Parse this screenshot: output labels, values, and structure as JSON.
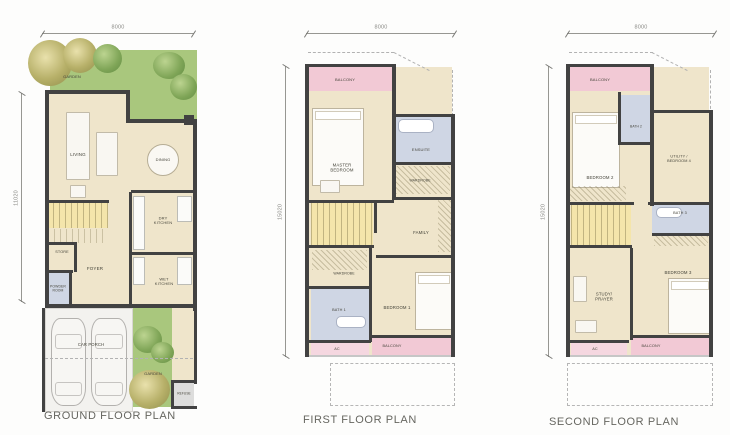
{
  "colors": {
    "wall": "#424242",
    "room": "#efe5cb",
    "balcony": "#f2c9d5",
    "ac": "#f5d7e0",
    "bath": "#cfd6e4",
    "stairs": "#f4e5ab",
    "garden": "#a9c77d",
    "porch": "#f3f2ef",
    "refuse": "#dddddc"
  },
  "plans": [
    {
      "id": "ground-floor",
      "title": "GROUND FLOOR PLAN",
      "tx": 44,
      "ty": 410,
      "dims": [
        {
          "o": "h",
          "label": "8000",
          "x": 42,
          "y": 33,
          "len": 152
        },
        {
          "o": "v",
          "label": "11020",
          "x": 21,
          "y": 93,
          "len": 209
        }
      ],
      "rooms": [
        {
          "id": "interior",
          "fill": "room",
          "x": 45,
          "y": 93,
          "w": 148,
          "h": 215
        },
        {
          "id": "garden-top",
          "fill": "garden",
          "x": 50,
          "y": 50,
          "w": 147,
          "h": 43,
          "label": "GARDEN",
          "lx": 72,
          "ly": 77,
          "fs": 4
        },
        {
          "id": "garden-top-right",
          "fill": "garden",
          "x": 128,
          "y": 93,
          "w": 69,
          "h": 29
        },
        {
          "id": "living",
          "label": "LIVING",
          "lx": 78,
          "ly": 155,
          "fs": 4.5
        },
        {
          "id": "dining",
          "label": "DINING",
          "lx": 163,
          "ly": 160,
          "fs": 4
        },
        {
          "id": "stairs",
          "fill": "stairs",
          "x": 47,
          "y": 203,
          "w": 61,
          "h": 25
        },
        {
          "id": "store",
          "label": "STORE",
          "lx": 62,
          "ly": 252,
          "fs": 3.8
        },
        {
          "id": "dry-kitchen",
          "label": "DRY\nKITCHEN",
          "lx": 163,
          "ly": 221,
          "fs": 4
        },
        {
          "id": "foyer",
          "label": "FOYER",
          "lx": 95,
          "ly": 269,
          "fs": 4.5
        },
        {
          "id": "powder-room",
          "fill": "bath",
          "x": 45,
          "y": 272,
          "w": 26,
          "h": 36,
          "label": "POWDER\nROOM",
          "lx": 58,
          "ly": 289,
          "fs": 3.4
        },
        {
          "id": "wet-kitchen",
          "label": "WET\nKITCHEN",
          "lx": 164,
          "ly": 282,
          "fs": 4
        },
        {
          "id": "walkway",
          "fill": "room",
          "x": 172,
          "y": 308,
          "w": 22,
          "h": 99
        },
        {
          "id": "car-porch",
          "fill": "porch",
          "x": 45,
          "y": 308,
          "w": 88,
          "h": 104,
          "label": "CAR PORCH",
          "lx": 91,
          "ly": 345,
          "fs": 4.2
        },
        {
          "id": "garden-bottom",
          "fill": "garden",
          "x": 133,
          "y": 308,
          "w": 39,
          "h": 99,
          "label": "GARDEN",
          "lx": 153,
          "ly": 374,
          "fs": 4
        },
        {
          "id": "refuse",
          "fill": "refuse",
          "x": 174,
          "y": 382,
          "w": 20,
          "h": 25,
          "label": "REFUSE",
          "lx": 184,
          "ly": 394,
          "fs": 3.2
        }
      ],
      "walls": [
        [
          45,
          90,
          85,
          4
        ],
        [
          126,
          90,
          4,
          33
        ],
        [
          126,
          119,
          71,
          4
        ],
        [
          45,
          90,
          4,
          218
        ],
        [
          193,
          119,
          4,
          192
        ],
        [
          45,
          304,
          152,
          4
        ],
        [
          45,
          200,
          64,
          3
        ],
        [
          45,
          242,
          32,
          3
        ],
        [
          74,
          242,
          3,
          30
        ],
        [
          45,
          270,
          28,
          3
        ],
        [
          69,
          270,
          3,
          38
        ],
        [
          129,
          192,
          3,
          116
        ],
        [
          131,
          190,
          62,
          3
        ],
        [
          131,
          252,
          62,
          3
        ],
        [
          42,
          308,
          3,
          104
        ],
        [
          194,
          308,
          3,
          76
        ],
        [
          171,
          380,
          26,
          3
        ],
        [
          171,
          380,
          3,
          27
        ],
        [
          171,
          406,
          26,
          3
        ],
        [
          184,
          115,
          10,
          10
        ]
      ],
      "decor": [
        {
          "type": "tree-olive",
          "x": 28,
          "y": 40,
          "w": 44,
          "h": 46
        },
        {
          "type": "tree-olive",
          "x": 63,
          "y": 38,
          "w": 34,
          "h": 35
        },
        {
          "type": "tree",
          "x": 93,
          "y": 44,
          "w": 29,
          "h": 29
        },
        {
          "type": "tree",
          "x": 153,
          "y": 52,
          "w": 32,
          "h": 27
        },
        {
          "type": "tree",
          "x": 170,
          "y": 74,
          "w": 27,
          "h": 26
        },
        {
          "type": "tree",
          "x": 133,
          "y": 326,
          "w": 29,
          "h": 27
        },
        {
          "type": "tree",
          "x": 151,
          "y": 342,
          "w": 23,
          "h": 21
        },
        {
          "type": "tree-olive",
          "x": 129,
          "y": 370,
          "w": 41,
          "h": 39
        },
        {
          "type": "car",
          "x": 51,
          "y": 318,
          "w": 35,
          "h": 88
        },
        {
          "type": "car",
          "x": 91,
          "y": 318,
          "w": 36,
          "h": 88
        },
        {
          "type": "furn",
          "x": 66,
          "y": 112,
          "w": 24,
          "h": 68
        },
        {
          "type": "furn",
          "x": 96,
          "y": 132,
          "w": 22,
          "h": 44
        },
        {
          "type": "furn",
          "x": 70,
          "y": 185,
          "w": 16,
          "h": 13
        },
        {
          "type": "table-round",
          "x": 147,
          "y": 144,
          "w": 32,
          "h": 32
        },
        {
          "type": "counter",
          "x": 133,
          "y": 196,
          "w": 12,
          "h": 54
        },
        {
          "type": "counter",
          "x": 177,
          "y": 196,
          "w": 15,
          "h": 26
        },
        {
          "type": "counter",
          "x": 133,
          "y": 257,
          "w": 12,
          "h": 28
        },
        {
          "type": "counter",
          "x": 177,
          "y": 257,
          "w": 15,
          "h": 28
        },
        {
          "type": "treads",
          "x": 48,
          "y": 229,
          "w": 58,
          "h": 14
        },
        {
          "type": "dash-h",
          "x": 45,
          "y": 358,
          "len": 148
        }
      ]
    },
    {
      "id": "first-floor",
      "title": "FIRST FLOOR PLAN",
      "tx": 303,
      "ty": 414,
      "dims": [
        {
          "o": "h",
          "label": "8000",
          "x": 306,
          "y": 33,
          "len": 149
        },
        {
          "o": "v",
          "label": "15020",
          "x": 285,
          "y": 66,
          "len": 291
        }
      ],
      "rooms": [
        {
          "id": "interior",
          "fill": "room",
          "x": 308,
          "y": 67,
          "w": 144,
          "h": 288
        },
        {
          "id": "balcony",
          "fill": "balcony",
          "x": 308,
          "y": 67,
          "w": 85,
          "h": 24,
          "label": "BALCONY",
          "lx": 345,
          "ly": 80,
          "fs": 4
        },
        {
          "id": "master-bedroom",
          "label": "MASTER\nBEDROOM",
          "lx": 342,
          "ly": 168,
          "fs": 4.3
        },
        {
          "id": "ensuite",
          "fill": "bath",
          "x": 395,
          "y": 117,
          "w": 56,
          "h": 46,
          "label": "ENSUITE",
          "lx": 421,
          "ly": 150,
          "fs": 4
        },
        {
          "id": "wardrobe-master",
          "label": "WARDROBE",
          "lx": 420,
          "ly": 181,
          "fs": 3.5
        },
        {
          "id": "stairs",
          "fill": "stairs",
          "x": 311,
          "y": 203,
          "w": 62,
          "h": 42
        },
        {
          "id": "family",
          "label": "FAMILY",
          "lx": 421,
          "ly": 233,
          "fs": 4.3
        },
        {
          "id": "wardrobe-hall",
          "label": "WARDROBE",
          "lx": 344,
          "ly": 274,
          "fs": 3.5
        },
        {
          "id": "bath-1",
          "fill": "bath",
          "x": 311,
          "y": 289,
          "w": 58,
          "h": 51,
          "label": "BATH 1",
          "lx": 339,
          "ly": 310,
          "fs": 3.8
        },
        {
          "id": "bedroom-1",
          "label": "BEDROOM 1",
          "lx": 397,
          "ly": 308,
          "fs": 4.3
        },
        {
          "id": "ac-ledge",
          "fill": "ac",
          "x": 311,
          "y": 343,
          "w": 58,
          "h": 12,
          "label": "AC",
          "lx": 337,
          "ly": 349,
          "fs": 3.8
        },
        {
          "id": "balcony-rear",
          "fill": "balcony",
          "x": 372,
          "y": 338,
          "w": 80,
          "h": 17,
          "label": "BALCONY",
          "lx": 392,
          "ly": 346,
          "fs": 3.8
        }
      ],
      "walls": [
        [
          305,
          64,
          4,
          293
        ],
        [
          305,
          64,
          91,
          3
        ],
        [
          392,
          64,
          4,
          135
        ],
        [
          392,
          114,
          63,
          3
        ],
        [
          451,
          114,
          4,
          243
        ],
        [
          396,
          162,
          58,
          3
        ],
        [
          392,
          197,
          63,
          3
        ],
        [
          308,
          200,
          86,
          3
        ],
        [
          376,
          255,
          78,
          3
        ],
        [
          308,
          245,
          66,
          3
        ],
        [
          308,
          286,
          64,
          3
        ],
        [
          369,
          248,
          3,
          94
        ],
        [
          374,
          203,
          3,
          30
        ],
        [
          308,
          340,
          63,
          3
        ],
        [
          369,
          335,
          86,
          3
        ]
      ],
      "decor": [
        {
          "type": "bed",
          "x": 312,
          "y": 108,
          "w": 52,
          "h": 78
        },
        {
          "type": "bed",
          "x": 415,
          "y": 272,
          "w": 38,
          "h": 58
        },
        {
          "type": "tub",
          "x": 398,
          "y": 119,
          "w": 36,
          "h": 14
        },
        {
          "type": "tub",
          "x": 336,
          "y": 316,
          "w": 30,
          "h": 12
        },
        {
          "type": "hatch",
          "x": 396,
          "y": 166,
          "w": 54,
          "h": 28
        },
        {
          "type": "hatch",
          "x": 312,
          "y": 250,
          "w": 55,
          "h": 20
        },
        {
          "type": "hatch",
          "x": 438,
          "y": 200,
          "w": 13,
          "h": 52
        },
        {
          "type": "furn",
          "x": 320,
          "y": 180,
          "w": 20,
          "h": 13
        },
        {
          "type": "dashed-rect",
          "x": 330,
          "y": 363,
          "w": 125,
          "h": 43
        },
        {
          "type": "dash-h",
          "x": 308,
          "y": 52,
          "len": 86
        },
        {
          "type": "dash-diag",
          "x": 394,
          "y": 52,
          "len": 40,
          "rot": 27
        },
        {
          "type": "dash-v",
          "x": 452,
          "y": 70,
          "len": 46
        },
        {
          "type": "line",
          "x": 305,
          "y": 355,
          "w": 150,
          "h": 2
        }
      ]
    },
    {
      "id": "second-floor",
      "title": "SECOND FLOOR PLAN",
      "tx": 549,
      "ty": 416,
      "dims": [
        {
          "o": "h",
          "label": "8000",
          "x": 567,
          "y": 33,
          "len": 148
        },
        {
          "o": "v",
          "label": "15020",
          "x": 548,
          "y": 66,
          "len": 291
        }
      ],
      "rooms": [
        {
          "id": "interior",
          "fill": "room",
          "x": 570,
          "y": 67,
          "w": 139,
          "h": 288
        },
        {
          "id": "balcony",
          "fill": "balcony",
          "x": 570,
          "y": 67,
          "w": 80,
          "h": 24,
          "label": "BALCONY",
          "lx": 600,
          "ly": 80,
          "fs": 4
        },
        {
          "id": "bedroom-2",
          "label": "BEDROOM 2",
          "lx": 600,
          "ly": 178,
          "fs": 4.3
        },
        {
          "id": "bath-2",
          "fill": "bath",
          "x": 621,
          "y": 95,
          "w": 30,
          "h": 48,
          "label": "BATH 2",
          "lx": 636,
          "ly": 127,
          "fs": 3.3
        },
        {
          "id": "utility-bedroom-4",
          "label": "UTILITY /\nBEDROOM 4",
          "lx": 679,
          "ly": 159,
          "fs": 3.8
        },
        {
          "id": "stairs",
          "fill": "stairs",
          "x": 571,
          "y": 203,
          "w": 60,
          "h": 42
        },
        {
          "id": "bath-3",
          "fill": "bath",
          "x": 652,
          "y": 205,
          "w": 57,
          "h": 29,
          "label": "BATH 3",
          "lx": 680,
          "ly": 213,
          "fs": 3.8
        },
        {
          "id": "study-prayer",
          "label": "STUDY/\nPRAYER",
          "lx": 604,
          "ly": 297,
          "fs": 4.2
        },
        {
          "id": "bedroom-3",
          "label": "BEDROOM 3",
          "lx": 678,
          "ly": 273,
          "fs": 4.3
        },
        {
          "id": "ac-ledge",
          "fill": "ac",
          "x": 571,
          "y": 343,
          "w": 56,
          "h": 12,
          "label": "AC",
          "lx": 595,
          "ly": 349,
          "fs": 3.8
        },
        {
          "id": "balcony-rear",
          "fill": "balcony",
          "x": 631,
          "y": 338,
          "w": 78,
          "h": 17,
          "label": "BALCONY",
          "lx": 651,
          "ly": 346,
          "fs": 3.8
        }
      ],
      "walls": [
        [
          566,
          64,
          4,
          293
        ],
        [
          566,
          64,
          88,
          3
        ],
        [
          650,
          64,
          4,
          31
        ],
        [
          650,
          90,
          4,
          116
        ],
        [
          618,
          92,
          3,
          53
        ],
        [
          621,
          142,
          31,
          3
        ],
        [
          653,
          110,
          58,
          3
        ],
        [
          709,
          110,
          4,
          247
        ],
        [
          568,
          202,
          66,
          3
        ],
        [
          648,
          202,
          63,
          3
        ],
        [
          652,
          233,
          59,
          3
        ],
        [
          568,
          245,
          64,
          3
        ],
        [
          630,
          248,
          3,
          92
        ],
        [
          568,
          340,
          61,
          3
        ],
        [
          630,
          335,
          83,
          3
        ]
      ],
      "decor": [
        {
          "type": "bed",
          "x": 572,
          "y": 112,
          "w": 48,
          "h": 76
        },
        {
          "type": "bed",
          "x": 668,
          "y": 278,
          "w": 44,
          "h": 56
        },
        {
          "type": "hatch",
          "x": 570,
          "y": 186,
          "w": 56,
          "h": 15
        },
        {
          "type": "hatch",
          "x": 654,
          "y": 236,
          "w": 54,
          "h": 10
        },
        {
          "type": "furn",
          "x": 573,
          "y": 276,
          "w": 14,
          "h": 26
        },
        {
          "type": "furn",
          "x": 575,
          "y": 320,
          "w": 22,
          "h": 13
        },
        {
          "type": "tub",
          "x": 656,
          "y": 207,
          "w": 26,
          "h": 11
        },
        {
          "type": "dashed-rect",
          "x": 567,
          "y": 363,
          "w": 146,
          "h": 43
        },
        {
          "type": "dash-h",
          "x": 569,
          "y": 52,
          "len": 84
        },
        {
          "type": "dash-diag",
          "x": 652,
          "y": 52,
          "len": 40,
          "rot": 27
        },
        {
          "type": "dash-v",
          "x": 710,
          "y": 70,
          "len": 44
        },
        {
          "type": "line",
          "x": 566,
          "y": 355,
          "w": 147,
          "h": 2
        }
      ]
    }
  ]
}
